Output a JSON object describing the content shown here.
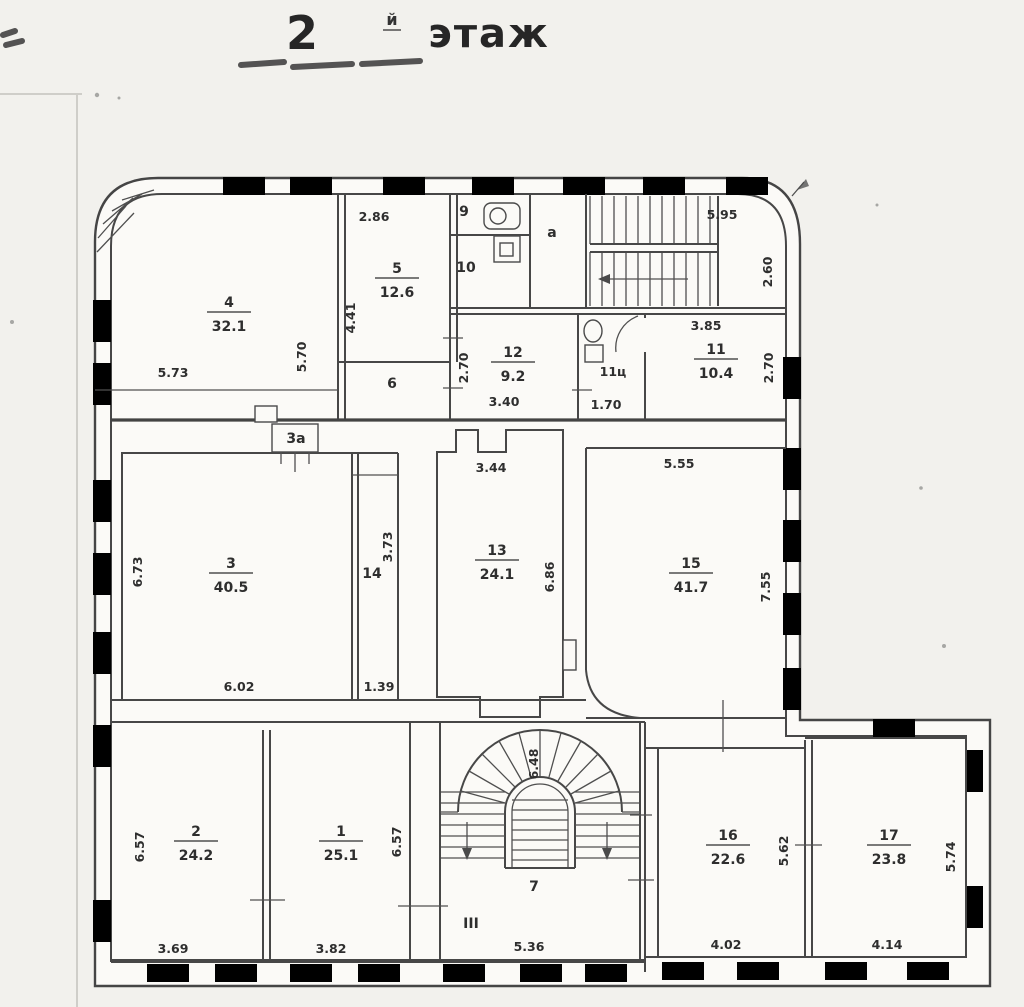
{
  "title": {
    "number": "2",
    "suffix": "й",
    "word": "этаж"
  },
  "rooms": {
    "r1": {
      "number": "1",
      "area": "25.1"
    },
    "r2": {
      "number": "2",
      "area": "24.2"
    },
    "r3": {
      "number": "3",
      "area": "40.5"
    },
    "r4": {
      "number": "4",
      "area": "32.1"
    },
    "r5": {
      "number": "5",
      "area": "12.6"
    },
    "r11": {
      "number": "11",
      "area": "10.4"
    },
    "r12": {
      "number": "12",
      "area": "9.2"
    },
    "r13": {
      "number": "13",
      "area": "24.1"
    },
    "r15": {
      "number": "15",
      "area": "41.7"
    },
    "r16": {
      "number": "16",
      "area": "22.6"
    },
    "r17": {
      "number": "17",
      "area": "23.8"
    }
  },
  "plain_rooms": {
    "r6": "6",
    "r7": "7",
    "r9": "9",
    "r10": "10",
    "r14": "14",
    "bay": "3а",
    "wc": "11ц",
    "hall": "а",
    "entrance": "III"
  },
  "dims": {
    "room4_w": "5.73",
    "room4_h": "5.70",
    "room5_w": "2.86",
    "room5_h": "4.41",
    "stair_top_w": "5.95",
    "stair_top_h": "2.60",
    "room12_w": "3.40",
    "room12_h": "2.70",
    "room11c_w": "1.70",
    "room11_w": "3.85",
    "room11_h": "2.70",
    "room3_w": "6.02",
    "room3_h": "6.73",
    "room14_w": "1.39",
    "room14_h": "3.73",
    "room13_w": "3.44",
    "room13_h": "6.86",
    "room15_w": "5.55",
    "room15_h": "7.55",
    "room2_w": "3.69",
    "room2_h": "6.57",
    "room1_w": "3.82",
    "room1_h": "6.57",
    "room7_w": "5.36",
    "stair_fan_h": "6.48",
    "room16_w": "4.02",
    "room16_h": "5.62",
    "room17_w": "4.14",
    "room17_h": "5.74"
  },
  "ink_color": "#474747",
  "paper_color": "#f2f1ed"
}
